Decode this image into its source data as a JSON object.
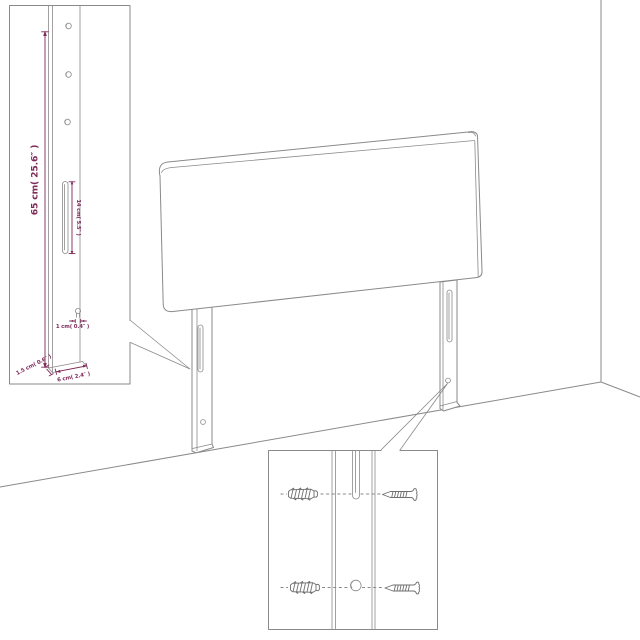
{
  "diagram_title": "headboard-assembly-dimension-diagram",
  "colors": {
    "line": "#8a8a8a",
    "hardware_line": "#6f6f6f",
    "dimension": "#7e2b59",
    "background": "#ffffff"
  },
  "top_left_detail": {
    "labels": {
      "height": "65 cm( 25.6″ )",
      "slot": "14 cm( 5.5″ )",
      "hole": "1 cm( 0.4″ )",
      "side_depth": "1.5 cm( 0.6″ )",
      "width": "6 cm( 2.4″ )"
    },
    "hole_count": 3
  },
  "bottom_detail": {
    "hardware_icons": [
      "wall-anchor-icon",
      "screw-icon",
      "wall-anchor-icon",
      "screw-icon"
    ]
  },
  "main_view": {
    "legs": 2,
    "slots_per_leg": 1,
    "holes_per_leg": 1
  }
}
